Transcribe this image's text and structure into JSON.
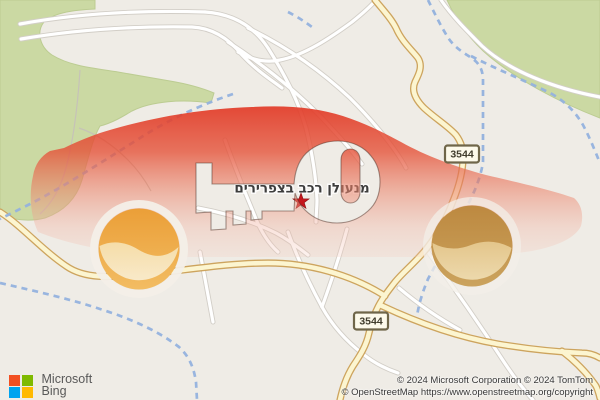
{
  "map": {
    "place_label": "מנעולן רכב בצפרירים",
    "marker": {
      "shape": "star",
      "color": "#c4161c"
    },
    "route_shields": [
      {
        "label": "3544"
      },
      {
        "label": "3544"
      }
    ],
    "colors": {
      "background": "#efece6",
      "green_area": "#cbd9a3",
      "road_fill": "#ffffff",
      "road_casing": "#d2cec7",
      "highway_fill": "#fcf5d0",
      "highway_casing": "#cda45e",
      "stream_blue": "#93b2de"
    }
  },
  "watermark": {
    "shape": "red-car-silhouette-with-key-cutout",
    "body_top_color": "#e23b28",
    "body_bottom_color": "#f5cdc0",
    "front_wheel_colors": [
      "#eb9f38",
      "#f9ecd0"
    ],
    "rear_wheel_colors": [
      "#bd8940",
      "#eedcb2"
    ]
  },
  "attribution": {
    "logo": {
      "line1": "Microsoft",
      "line2": "Bing",
      "square_colors": [
        "#f25022",
        "#7fba00",
        "#00a4ef",
        "#ffb900"
      ]
    },
    "copyright_line1": "© 2024 Microsoft Corporation © 2024 TomTom",
    "copyright_line2": "© OpenStreetMap https://www.openstreetmap.org/copyright"
  }
}
